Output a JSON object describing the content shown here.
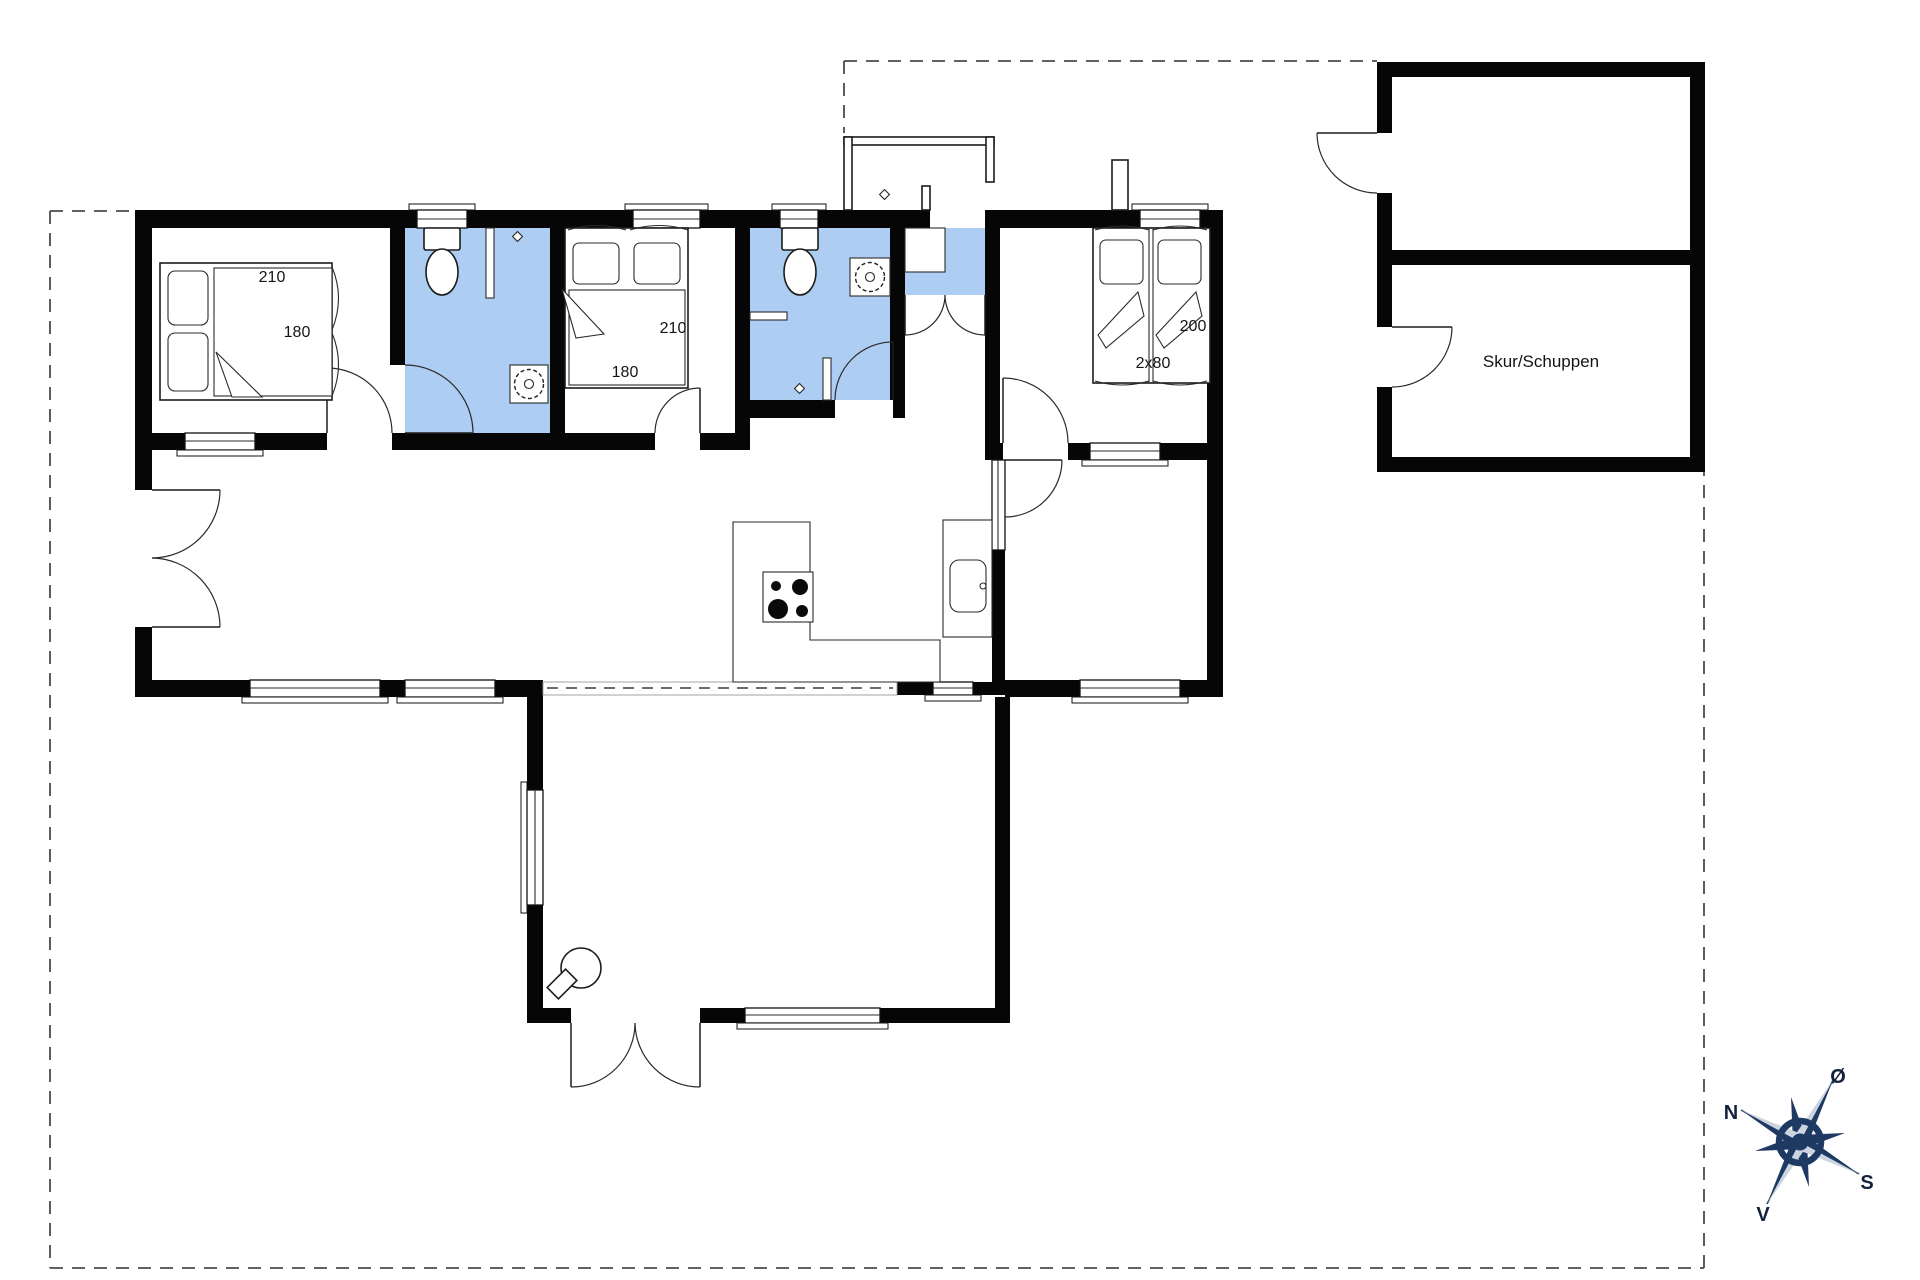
{
  "plan": {
    "bedroom1": {
      "bed_length": "210",
      "bed_width": "180"
    },
    "bedroom2": {
      "bed_length": "210",
      "bed_width": "180"
    },
    "bedroom3": {
      "bed_length": "200",
      "bed_width": "2x80"
    },
    "shed": {
      "label": "Skur/Schuppen"
    },
    "compass": {
      "north": "N",
      "east": "Ø",
      "south": "S",
      "west": "V"
    }
  },
  "colors": {
    "wall": "#060606",
    "wet_room_fill": "#aecdf2",
    "boundary_dash": "#4b4b4b",
    "compass_navy": "#1e3a63",
    "compass_light": "#ccd4e0",
    "background": "#ffffff"
  }
}
